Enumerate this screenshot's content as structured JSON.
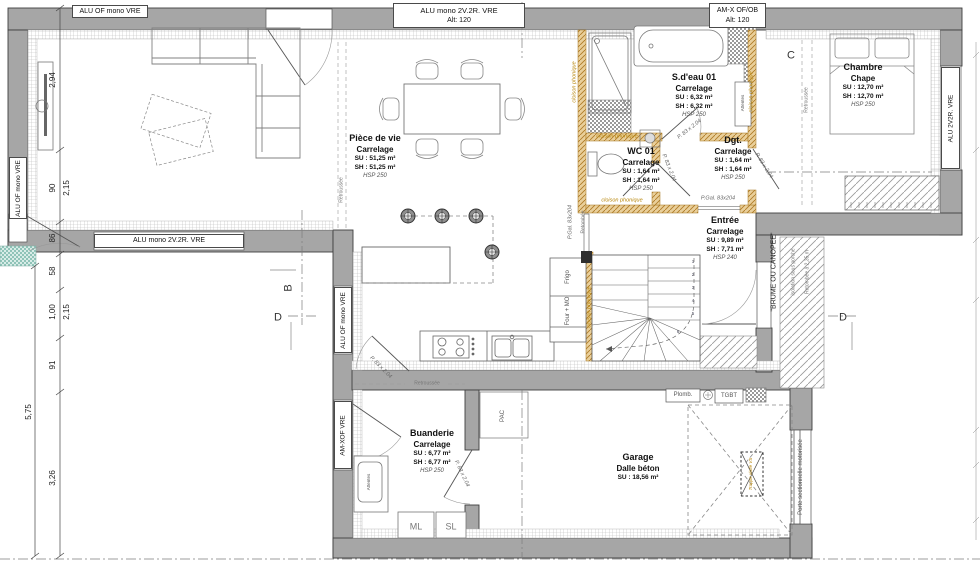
{
  "colors": {
    "cloison_text": "#b8860b",
    "exterior_tile": "#8fc3b8",
    "wall": "#a6a6a6"
  },
  "windows": {
    "top_left": "ALU OF mono VRE",
    "top_center": {
      "line1": "ALU mono 2V.2R. VRE",
      "line2": "Alt: 120"
    },
    "top_right": {
      "line1": "AM-X OF/OB",
      "line2": "Alt: 120"
    },
    "left_wall": "ALU OF mono VRE",
    "sw_wall": "ALU mono 2V.2R. VRE",
    "west_wall_upper": "ALU OF mono VRE",
    "west_wall_lower": "AM-XOF VRE",
    "east_wall": "ALU 2V2R. VRE"
  },
  "rooms": {
    "piece_de_vie": {
      "name": "Pièce de vie",
      "floor": "Carrelage",
      "su": "SU : 51,25 m²",
      "sh": "SH : 51,25 m²",
      "hsp": "HSP 250"
    },
    "sdeau": {
      "name": "S.d'eau 01",
      "floor": "Carrelage",
      "su": "SU : 6,32 m²",
      "sh": "SH : 6,32 m²",
      "hsp": "HSP 250"
    },
    "wc": {
      "name": "WC 01",
      "floor": "Carrelage",
      "su": "SU : 1,64 m²",
      "sh": "SH : 1,64 m²",
      "hsp": "HSP 250"
    },
    "dgt": {
      "name": "Dgt.",
      "floor": "Carrelage",
      "su": "SU : 1,64 m²",
      "sh": "SH : 1,64 m²",
      "hsp": "HSP 250"
    },
    "chambre": {
      "name": "Chambre",
      "floor": "Chape",
      "su": "SU : 12,70 m²",
      "sh": "SH : 12,70 m²",
      "hsp": "HSP 250"
    },
    "entree": {
      "name": "Entrée",
      "floor": "Carrelage",
      "su": "SU : 9,89 m²",
      "sh": "SH : 7,71 m²",
      "hsp": "HSP 240"
    },
    "buanderie": {
      "name": "Buanderie",
      "floor": "Carrelage",
      "su": "SU : 6,77 m²",
      "sh": "SH : 6,77 m²",
      "hsp": "HSP 250"
    },
    "garage": {
      "name": "Garage",
      "floor": "Dalle béton",
      "su": "SU : 18,56 m²"
    }
  },
  "doors": {
    "p83": "P. 83 x 2.04",
    "pgal": "P.Gal. 83x204",
    "sectional": "Porte sectionnelle motorisée"
  },
  "annotations": {
    "cloison": "cloison phonique",
    "retombee": "Retombée",
    "retroussee": "Retroussée",
    "brume": "\"BRUME OU CANOPEE\"",
    "isolation": "Isolation sous porche",
    "retombee_235": "Retombée à 2,35 m",
    "trappe": "Trappe visite VS"
  },
  "equipment": {
    "frigo": "Frigo",
    "four_mo": "Four + MO",
    "ml": "ML",
    "sl": "SL",
    "pac": "PAC",
    "plomb": "Plomb.",
    "tgbt": "TGBT",
    "attentes": "Attentes"
  },
  "sections": {
    "b": "B",
    "c": "C",
    "d": "D"
  },
  "dimensions": {
    "v294": "2,94",
    "v90": "90",
    "v215": "2,15",
    "v86": "86",
    "v58": "58",
    "v100": "1,00",
    "v91": "91",
    "v575": "5,75",
    "v326": "3,26"
  },
  "stairs": {
    "numbers": [
      "1",
      "2",
      "3",
      "4",
      "5",
      "6"
    ]
  }
}
